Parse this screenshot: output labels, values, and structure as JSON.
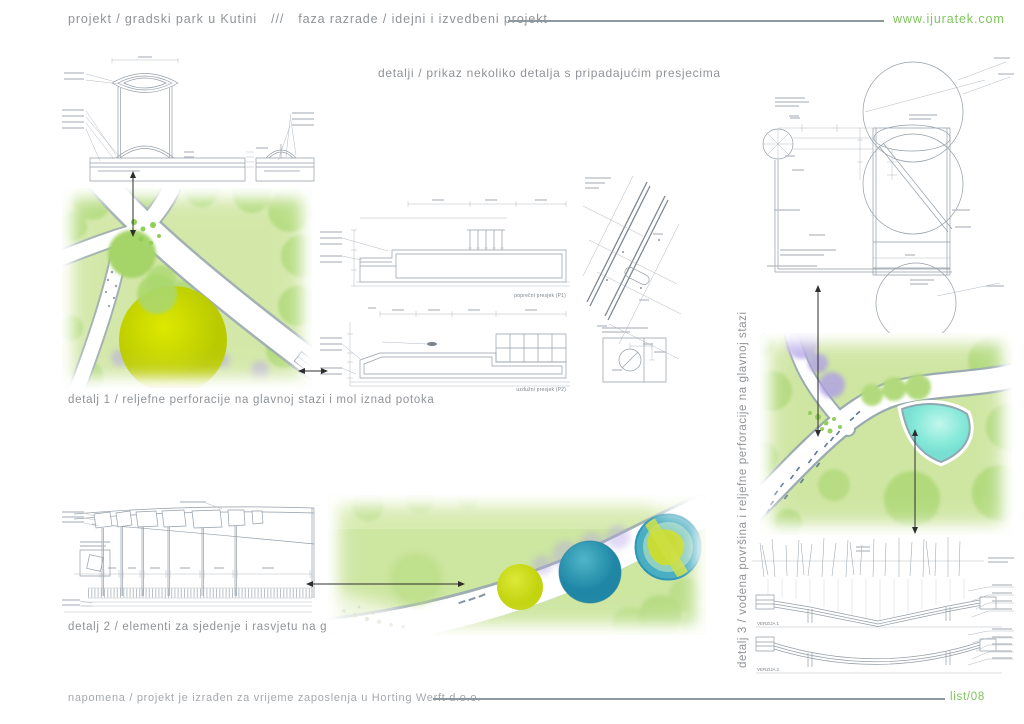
{
  "header": {
    "project": "projekt / gradski park u Kutini",
    "separator": "///",
    "phase": "faza razrade / idejni i izvedbeni projekt",
    "website": "www.ijuratek.com"
  },
  "subtitle": "detalji / prikaz nekoliko detalja s pripadajućim presjecima",
  "details": {
    "detail1_caption": "detalj 1 / reljefne perforacije na glavnoj stazi i mol iznad potoka",
    "detail2_caption": "detalj 2 / elementi za sjedenje i rasvjetu na glavnoj stazi",
    "detail3_caption": "detalj 3 /  vodena površina i reljefne perforacije na glavnoj stazi"
  },
  "drawings": {
    "section1_label": "poprečni presjek (P1)",
    "section2_label": "uzdužni presjek (P2)",
    "version1_label": "VERZIJA 1",
    "version2_label": "VERZIJA 2"
  },
  "footer": {
    "note": "napomena / projekt je izrađen za vrijeme zaposlenja u Horting Werft d.o.o.",
    "sheet": "list/08"
  },
  "colors": {
    "accent_green": "#7fc55c",
    "text_gray": "#8f9397",
    "line_gray": "#8e979e",
    "drawing_line": "#949ea8",
    "plan_green": "#d3e8a8",
    "tree_green": "#b4dc7e",
    "big_yellow": "#c6d400",
    "water_cyan": "#86e9d9",
    "lavender": "#b3a3e6",
    "teal": "#2e9ab8"
  }
}
